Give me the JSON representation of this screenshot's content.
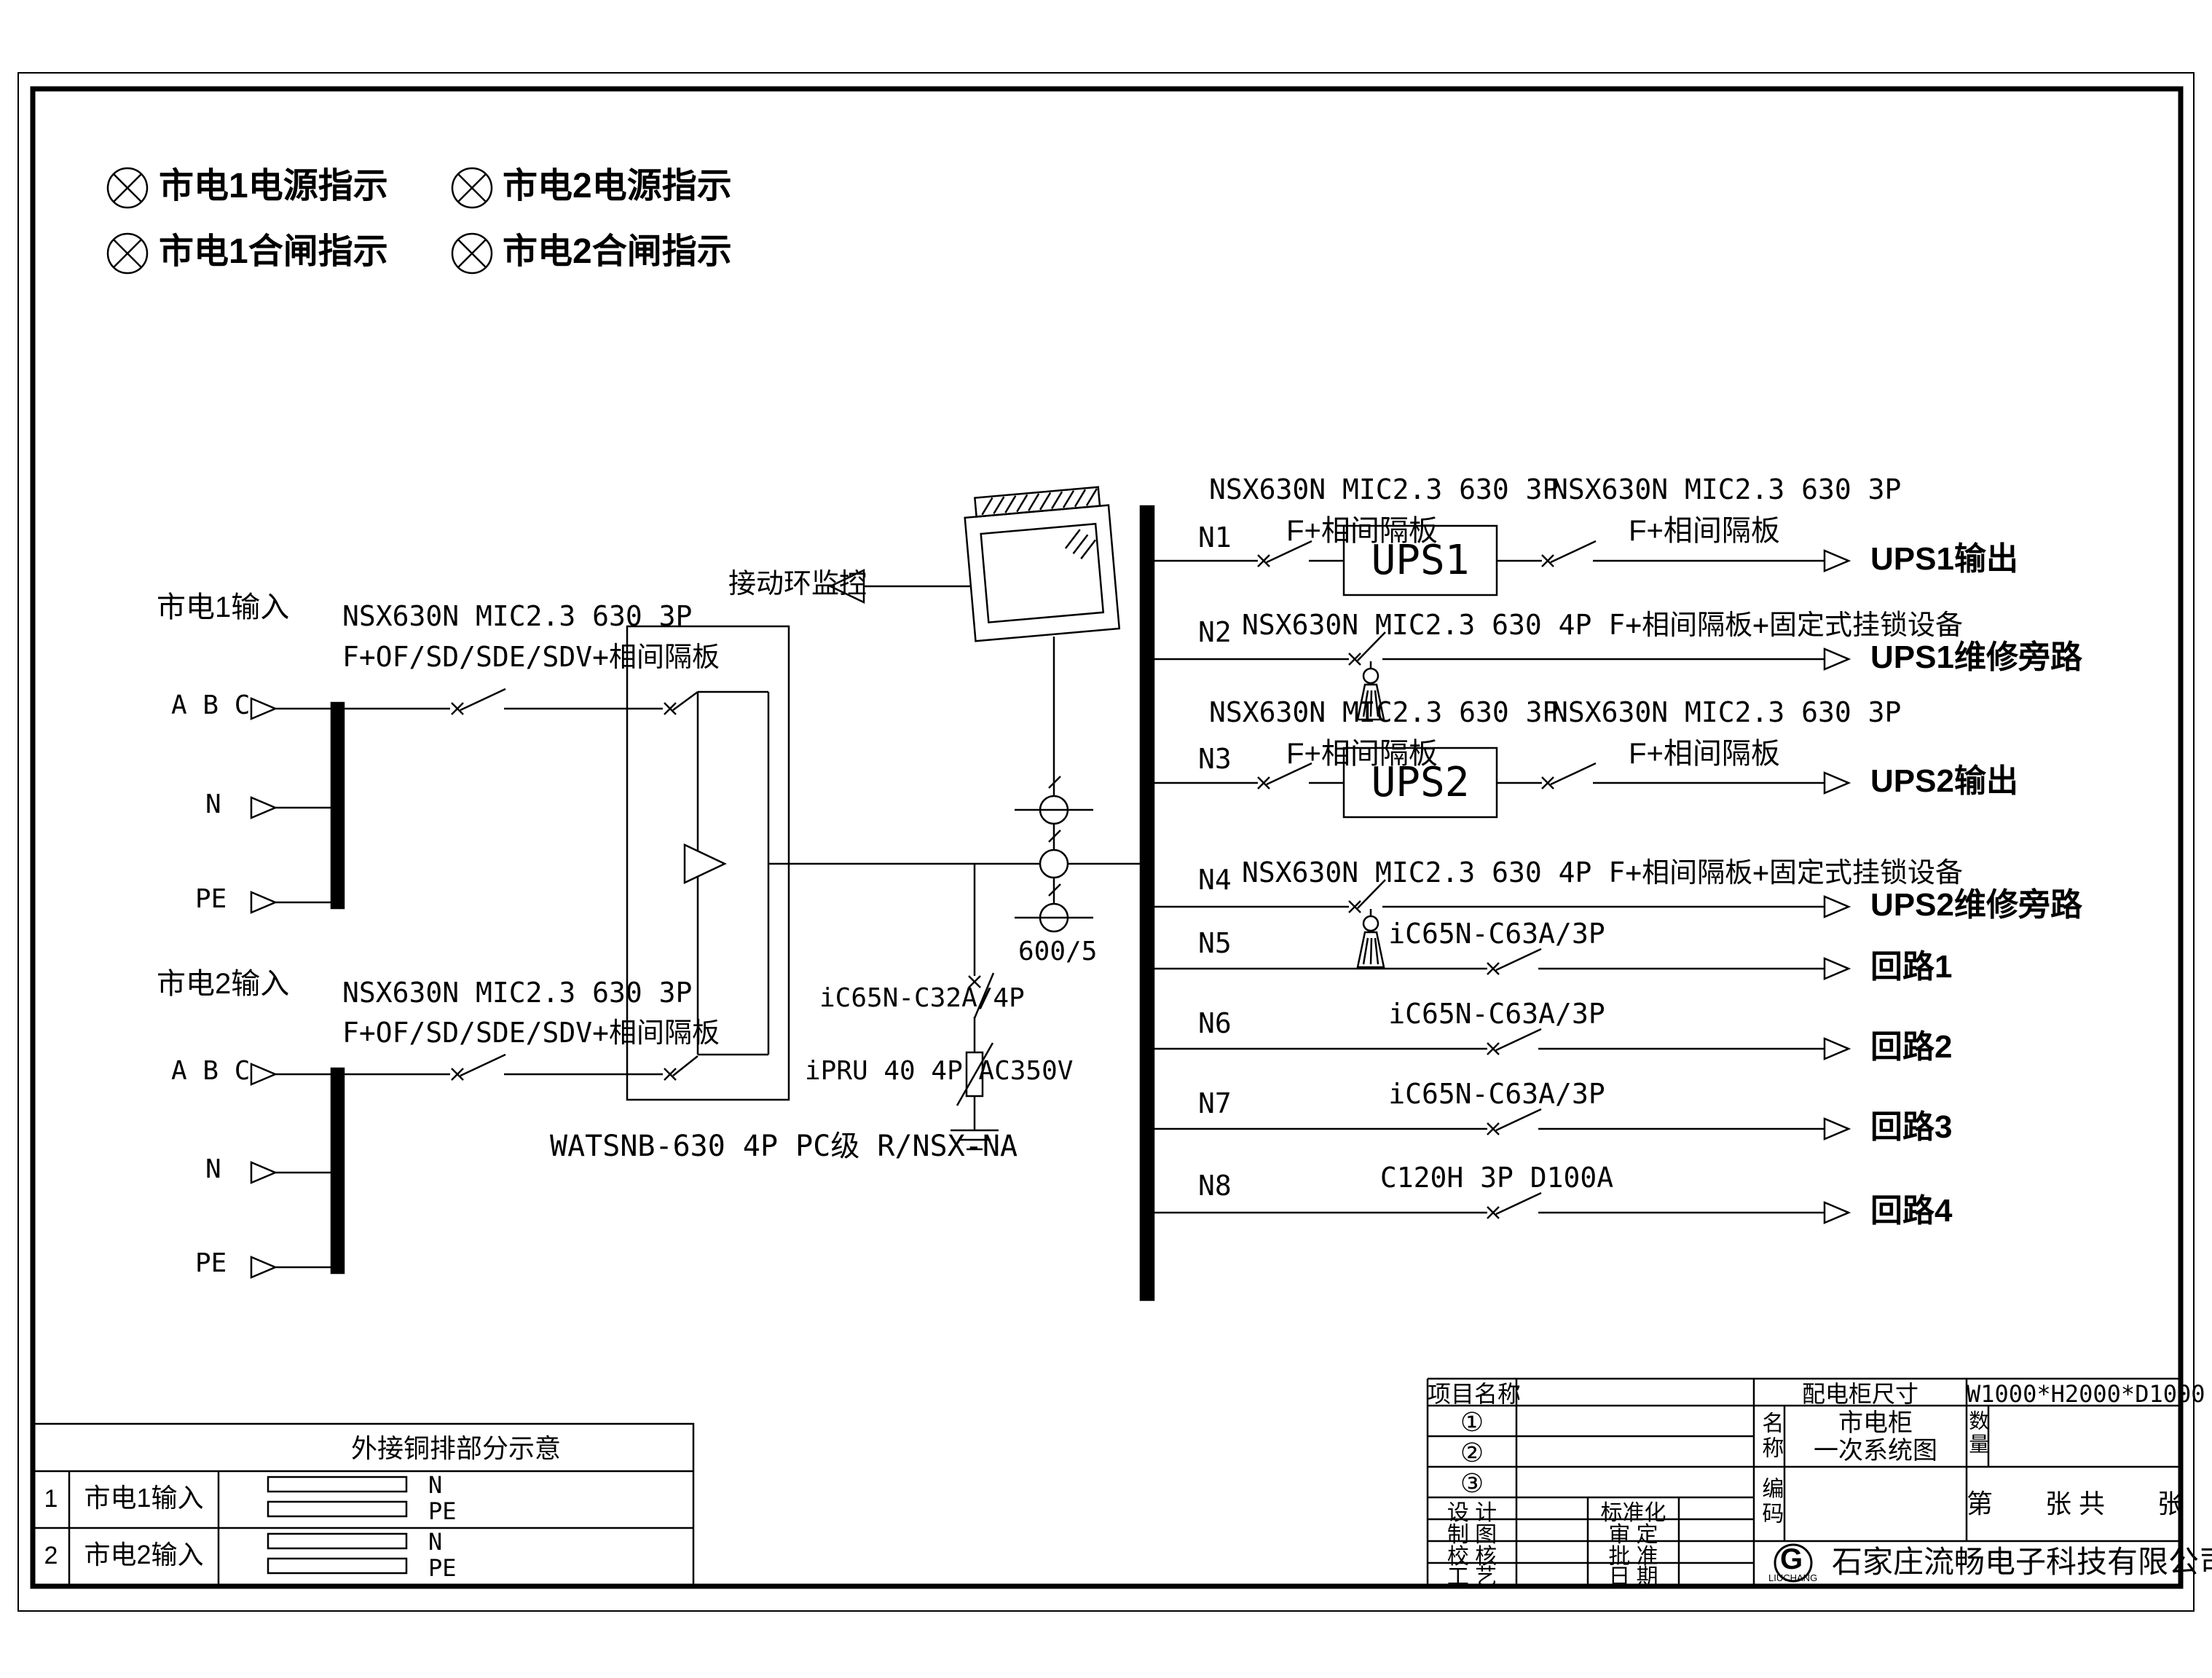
{
  "accent_color": "#000000",
  "paper_color": "#ffffff",
  "legend": {
    "items": [
      {
        "label": "市电1电源指示"
      },
      {
        "label": "市电2电源指示"
      },
      {
        "label": "市电1合闸指示"
      },
      {
        "label": "市电2合闸指示"
      }
    ]
  },
  "inputs": [
    {
      "title": "市电1输入",
      "breaker_model": "NSX630N MIC2.3 630 3P",
      "breaker_spec": "F+OF/SD/SDE/SDV+相间隔板",
      "phases": "A B C",
      "neutral": "N",
      "pe": "PE"
    },
    {
      "title": "市电2输入",
      "breaker_model": "NSX630N MIC2.3 630 3P",
      "breaker_spec": "F+OF/SD/SDE/SDV+相间隔板",
      "phases": "A B C",
      "neutral": "N",
      "pe": "PE"
    }
  ],
  "ats": {
    "model": "WATSNB-630 4P PC级 R/NSX-NA"
  },
  "monitor": {
    "label": "接动环监控"
  },
  "ct": {
    "ratio": "600/5"
  },
  "spd": {
    "breaker": "iC65N-C32A/4P",
    "device": "iPRU 40 4P AC350V"
  },
  "bus_feeders": [
    {
      "id": "N1",
      "label_main": "NSX630N MIC2.3 630 3P",
      "label_sub": "F+相间隔板",
      "label_main2": "NSX630N MIC2.3 630 3P",
      "label_sub2": "F+相间隔板",
      "device": "UPS1",
      "output": "UPS1输出"
    },
    {
      "id": "N2",
      "label_main": "NSX630N MIC2.3 630 4P F+相间隔板+固定式挂锁设备",
      "output": "UPS1维修旁路"
    },
    {
      "id": "N3",
      "label_main": "NSX630N MIC2.3 630 3P",
      "label_sub": "F+相间隔板",
      "label_main2": "NSX630N MIC2.3 630 3P",
      "label_sub2": "F+相间隔板",
      "device": "UPS2",
      "output": "UPS2输出"
    },
    {
      "id": "N4",
      "label_main": "NSX630N MIC2.3 630 4P F+相间隔板+固定式挂锁设备",
      "output": "UPS2维修旁路"
    },
    {
      "id": "N5",
      "label_main": "iC65N-C63A/3P",
      "output": "回路1"
    },
    {
      "id": "N6",
      "label_main": "iC65N-C63A/3P",
      "output": "回路2"
    },
    {
      "id": "N7",
      "label_main": "iC65N-C63A/3P",
      "output": "回路3"
    },
    {
      "id": "N8",
      "label_main": "C120H 3P D100A",
      "output": "回路4"
    }
  ],
  "copper_table": {
    "title": "外接铜排部分示意",
    "rows": [
      {
        "num": "1",
        "name": "市电1输入",
        "bar1": "N",
        "bar2": "PE"
      },
      {
        "num": "2",
        "name": "市电2输入",
        "bar1": "N",
        "bar2": "PE"
      }
    ]
  },
  "title_block": {
    "project_label": "项目名称",
    "item1": "①",
    "item2": "②",
    "item3": "③",
    "size_label": "配电柜尺寸",
    "size_value": "W1000*H2000*D1000",
    "name_label": "名称",
    "name_line1": "市电柜",
    "name_line2": "一次系统图",
    "qty_label": "数量",
    "code_label": "编码",
    "sheet_text": "第　　张 共　　张",
    "design_label": "设  计",
    "draft_label": "制  图",
    "check_label": "校  核",
    "craft_label": "工  艺",
    "std_label": "标准化",
    "review_label": "审  定",
    "approve_label": "批  准",
    "date_label": "日  期",
    "company": "石家庄流畅电子科技有限公司",
    "logo_letter": "G",
    "logo_sub": "LIUCHANG"
  }
}
